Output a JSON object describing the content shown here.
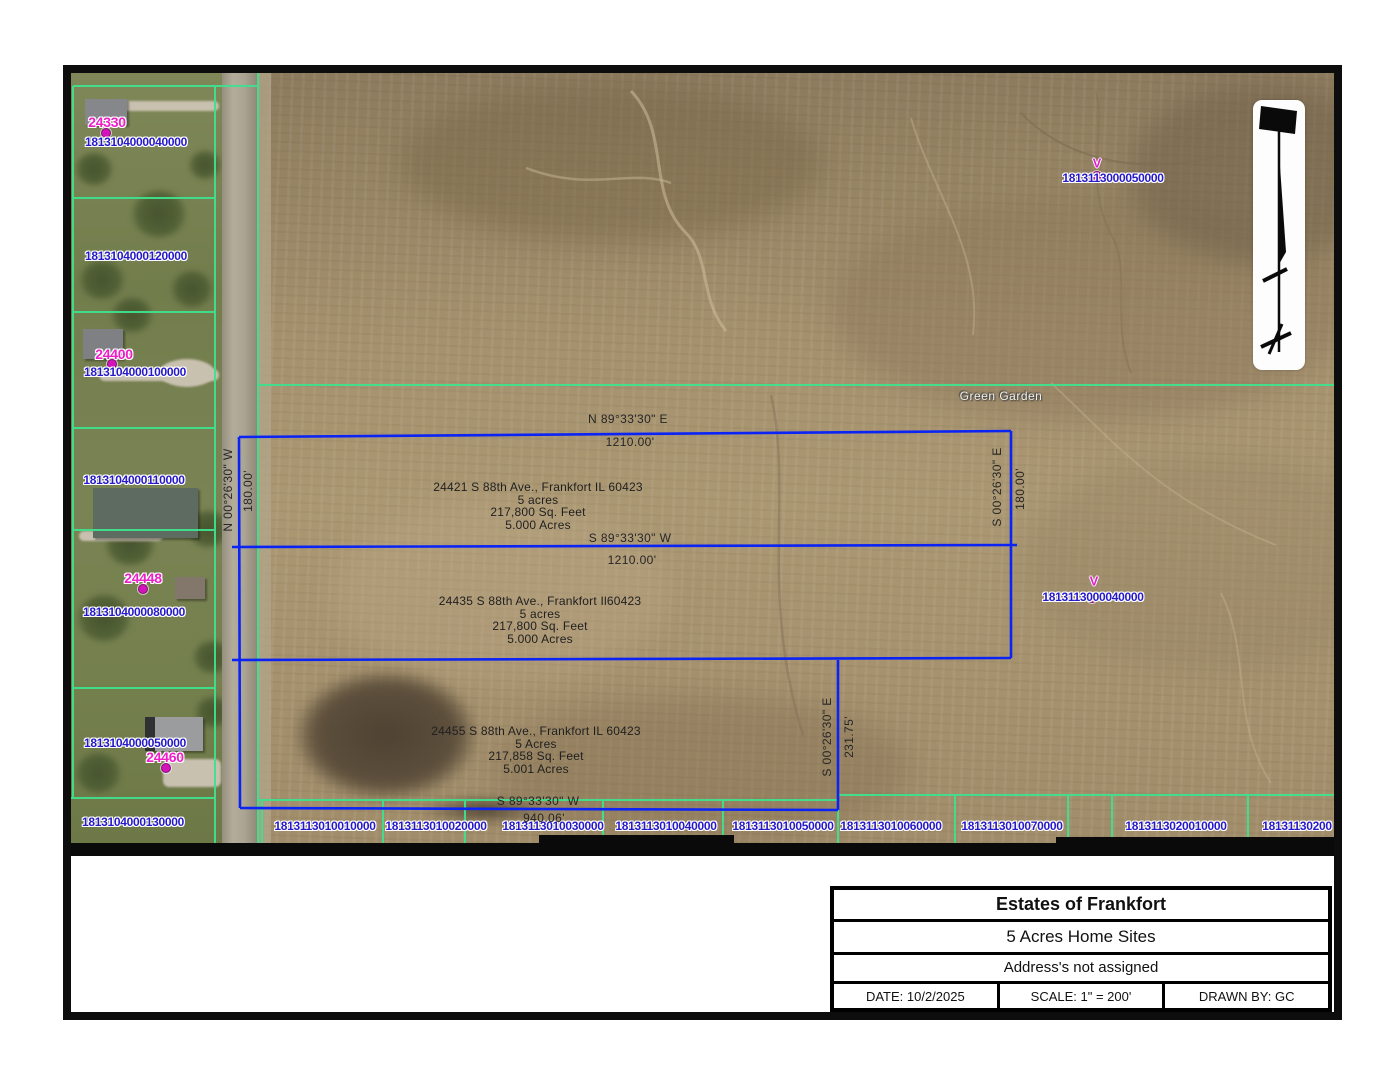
{
  "title_block": {
    "title": "Estates of Frankfort",
    "subtitle": "5 Acres Home Sites",
    "note": "Address's not assigned",
    "date": "DATE: 10/2/2025",
    "scale": "SCALE: 1\" = 200'",
    "drawn_by": "DRAWN BY: GC"
  },
  "map": {
    "road_label": "Green Garden",
    "lots": [
      {
        "address": "24421 S 88th Ave., Frankfort IL 60423",
        "size_note": "5 acres",
        "sqft": "217,800 Sq. Feet",
        "acres": "5.000 Acres"
      },
      {
        "address": "24435 S 88th Ave., Frankfort Il60423",
        "size_note": "5 acres",
        "sqft": "217,800 Sq. Feet",
        "acres": "5.000 Acres"
      },
      {
        "address": "24455 S 88th Ave., Frankfort IL 60423",
        "size_note": "5 Acres",
        "sqft": "217,858 Sq. Feet",
        "acres": "5.001 Acres"
      }
    ],
    "bearings": {
      "top_bearing": "N 89°33'30\" E",
      "top_distance": "1210.00'",
      "mid_bearing": "S 89°33'30\" W",
      "mid_distance": "1210.00'",
      "bottom_bearing": "S 89°33'30\" W",
      "bottom_distance": "940.06'",
      "west_bearing": "N 00°26'30\" W",
      "west_distance": "180.00'",
      "east_bearing": "S 00°26'30\" E",
      "east_distance": "180.00'",
      "inner_bearing": "S 00°26'30\" E",
      "inner_distance": "231.75'"
    },
    "west_parcels": [
      {
        "pin": "1813104000040000",
        "address_no": "24330"
      },
      {
        "pin": "1813104000120000"
      },
      {
        "pin": "1813104000100000",
        "address_no": "24400"
      },
      {
        "pin": "1813104000110000"
      },
      {
        "pin": "1813104000080000",
        "address_no": "24448"
      },
      {
        "pin": "1813104000050000",
        "address_no": "24460"
      },
      {
        "pin": "1813104000130000"
      }
    ],
    "south_parcels": [
      "1813113010010000",
      "1813113010020000",
      "1813113010030000",
      "1813113010040000",
      "1813113010050000",
      "1813113010060000",
      "1813113010070000",
      "1813113020010000",
      "18131130200"
    ],
    "field_markers": [
      {
        "flag": "V",
        "pin": "1813113000050000"
      },
      {
        "flag": "V",
        "pin": "1813113000040000"
      }
    ]
  },
  "colors": {
    "parcel_line_green": "#3fe18e",
    "plat_line_blue": "#0b24f5",
    "pin_text_blue": "#2619c9",
    "address_magenta": "#ee1ec8",
    "frame_black": "#0d0d0d"
  }
}
